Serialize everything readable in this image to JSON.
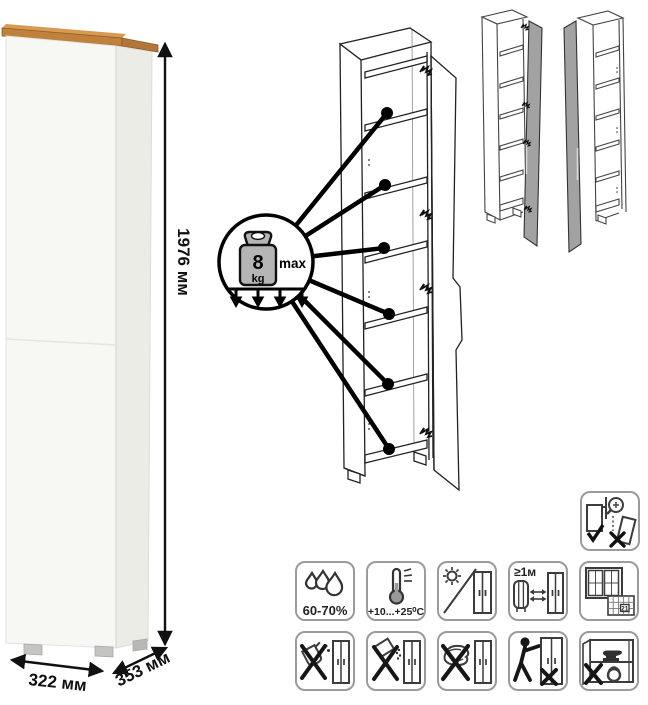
{
  "diagram": {
    "title_hint": "tall one-door cabinet product dimension and care diagram",
    "dimensions": {
      "height": "1976 мм",
      "width": "322 мм",
      "depth": "353 мм"
    },
    "shelf_load": {
      "value": "8",
      "unit": "kg",
      "qualifier": "max",
      "shelves_pointed": 6
    },
    "care": {
      "humidity_label": "60-70%",
      "temperature_label": "+10...+25⁰C",
      "heat_distance_label": "≥1м",
      "airing_day": "21"
    },
    "care_icon_names": [
      "humidity-60-70",
      "temperature-range",
      "no-direct-sunlight",
      "heat-source-distance",
      "ventilation-calendar",
      "wall-anchor-required",
      "no-liquids",
      "no-abrasive-powder",
      "no-abrasive-sponge",
      "no-dragging",
      "no-shelf-overload"
    ],
    "colors": {
      "wood_top": "#c0813c",
      "cabinet_white": "#f7f7f4",
      "cabinet_side": "#ecece7",
      "door_gray": "#a2a2a2",
      "line_art": "#222222",
      "icon_border": "#9b9b9b"
    }
  }
}
